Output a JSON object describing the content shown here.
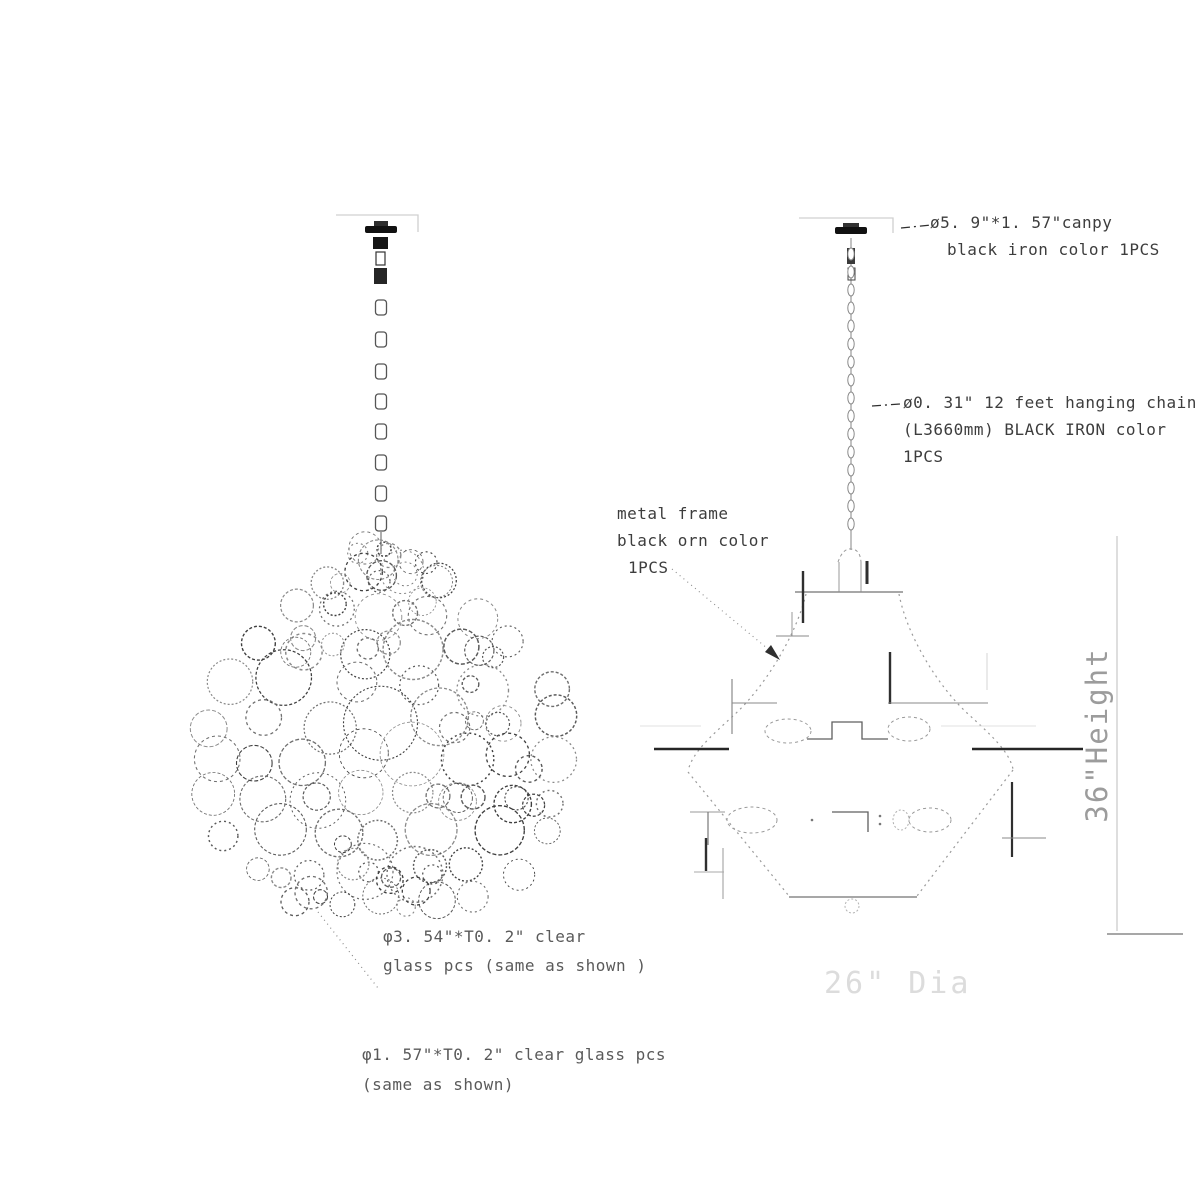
{
  "colors": {
    "line_gray": "#8a8a8a",
    "dark_ink": "#262626",
    "faint_gray": "#dcdcdc",
    "note_text": "#3d3d3d"
  },
  "annotations": {
    "canopy": {
      "line1": "ø5. 9\"*1. 57\"canpy",
      "line2": "black iron color 1PCS"
    },
    "chain": {
      "line1": "ø0. 31\" 12 feet hanging chain",
      "line2": "(L3660mm) BLACK IRON color",
      "line3": "1PCS"
    },
    "frame": {
      "line1": "metal frame",
      "line2": "black orn color",
      "line3": "1PCS"
    },
    "glass_large": {
      "line1": "φ3. 54\"*T0. 2\" clear",
      "line2": "glass pcs (same as shown )"
    },
    "glass_small": {
      "line1": "φ1. 57\"*T0. 2\" clear glass pcs",
      "line2": "(same as shown)"
    },
    "height_dim": "36\"Height",
    "dia_dim": "26\" Dia"
  }
}
